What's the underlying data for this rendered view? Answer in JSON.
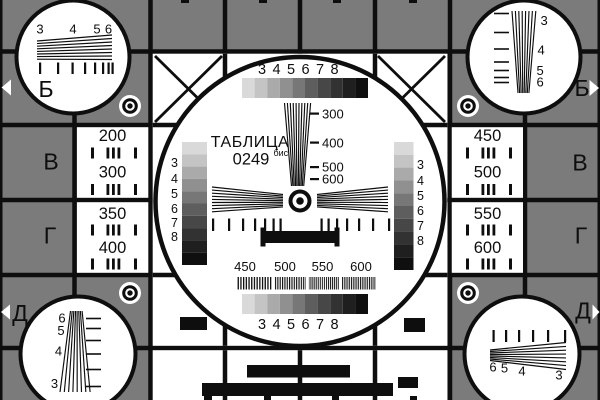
{
  "card": {
    "title": "ТАБЛИЦА",
    "code": "0249",
    "code_sup": "бис"
  },
  "colors": {
    "background_gray": "#7b7b7b",
    "line_black": "#0e0e0e",
    "white": "#ffffff"
  },
  "grayscale": {
    "steps": [
      "#d9d9d9",
      "#c4c4c4",
      "#aaaaaa",
      "#909090",
      "#777777",
      "#5e5e5e",
      "#474747",
      "#323232",
      "#1f1f1f",
      "#0f0f0f"
    ]
  },
  "center": {
    "top_scale": [
      "3",
      "4",
      "5",
      "6",
      "7",
      "8"
    ],
    "bottom_scale": [
      "3",
      "4",
      "5",
      "6",
      "7",
      "8"
    ],
    "wedge_labels": [
      "300",
      "400",
      "500",
      "600"
    ],
    "freq_labels": [
      "450",
      "500",
      "550",
      "600"
    ],
    "strip_labels": [
      "3",
      "4",
      "5",
      "6",
      "7",
      "8"
    ]
  },
  "corners": {
    "top_left": {
      "labels": [
        "3",
        "4",
        "5",
        "6"
      ]
    },
    "top_right": {
      "labels": [
        "3",
        "4",
        "5",
        "6"
      ]
    },
    "bottom_left": {
      "labels": [
        "6",
        "5",
        "4",
        "3"
      ]
    },
    "bottom_right": {
      "labels": [
        "6",
        "5",
        "4",
        "3"
      ]
    }
  },
  "side_letters": {
    "left": [
      "Б",
      "В",
      "Г",
      "Д"
    ],
    "right": [
      "Б",
      "В",
      "Г",
      "Д"
    ]
  },
  "panels": {
    "left_top": [
      "200",
      "300"
    ],
    "left_bottom": [
      "350",
      "400"
    ],
    "right_top": [
      "450",
      "500"
    ],
    "right_bottom": [
      "550",
      "600"
    ]
  }
}
